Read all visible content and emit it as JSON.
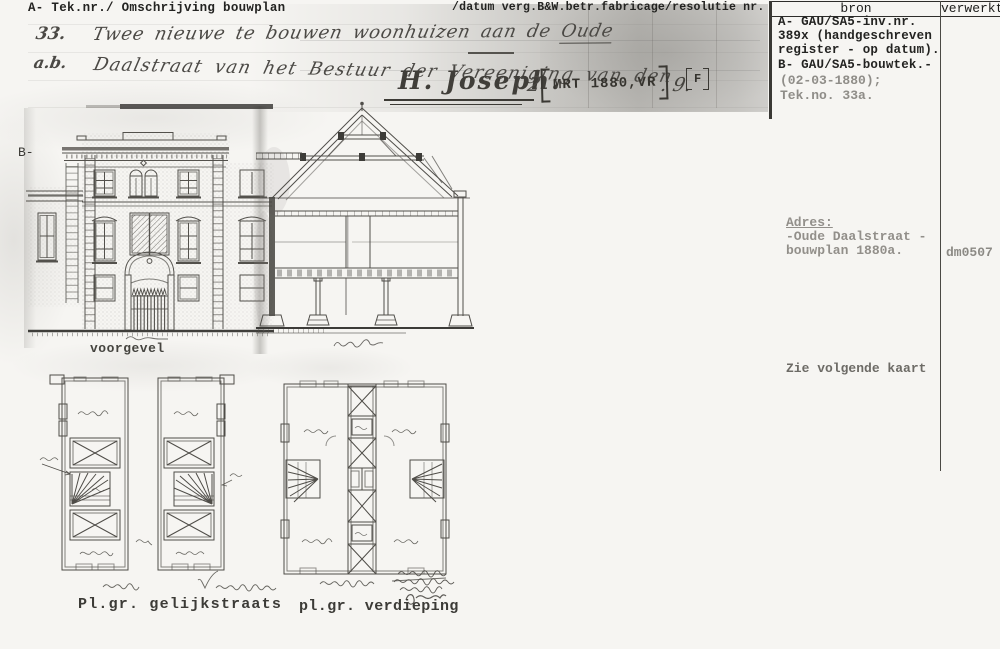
{
  "header": {
    "left": "A- Tek.nr./ Omschrijving bouwplan",
    "middle": "/datum verg.B&W.betr.fabricage/resolutie nr.",
    "col_bron": "bron",
    "col_verwerkt": "verwerkt"
  },
  "margin": {
    "b_label": "B-"
  },
  "handwriting": {
    "number": "33.",
    "line1_pre": "Twee nieuwe te bouwen woonhuizen aan de ",
    "line1_underlined": "Oude",
    "sub_number": "a.b.",
    "line2": "Daalstraat van het Bestuur der Vereeniging van den",
    "signature": "H. Joseph.",
    "after_signature": "2",
    "stamp": "MRT 1880,VR",
    "after_stamp": ". 9.",
    "flag": "F"
  },
  "drawing_labels": {
    "facade": "voorgevel",
    "plan_ground": "Pl.gr. gelijkstraats",
    "plan_upper": "pl.gr. verdieping"
  },
  "bron_column": {
    "block1": [
      "A- GAU/SA5-inv.nr.",
      "389x (handgeschreven",
      "register - op datum).",
      "B- GAU/SA5-bouwtek.-"
    ],
    "block2": [
      "(02-03-1880);",
      "Tek.no. 33a."
    ],
    "adres_title": "Adres:",
    "adres_lines": [
      "-Oude Daalstraat -",
      "bouwplan 1880a."
    ],
    "note": "Zie volgende kaart"
  },
  "verwerkt_column": {
    "code": "dm0507"
  },
  "colors": {
    "paper": "#f6f5f2",
    "typewriter_ink": "#232321",
    "typewriter_faded": "#8f8d88",
    "handwriting_ink": "#4b4945",
    "drawing_line": "#53514c",
    "scan_shade": "#7d7b76"
  }
}
